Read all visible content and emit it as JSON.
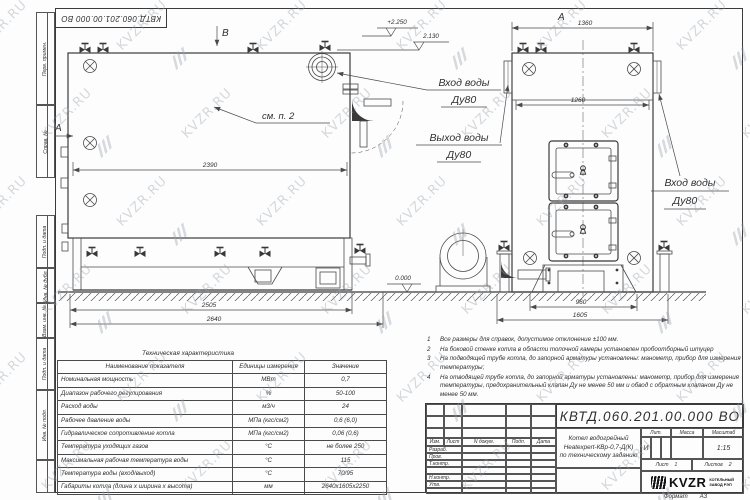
{
  "watermark": {
    "text": "KVZR.RU"
  },
  "frame": {
    "left_top": [
      "Перв. примен.",
      "Справ. №"
    ],
    "left_bottom": [
      "Подп. и дата",
      "Инв. № дубл.",
      "Взам. инв. №",
      "Подп. и дата",
      "Инв. № подл."
    ]
  },
  "drawing": {
    "section_a": "А",
    "section_b": "В",
    "view_label": "А",
    "callout": "см. п. 2",
    "inlet_label": "Вход воды",
    "outlet_label": "Выход воды",
    "dn_label": "Ду80",
    "level_top": "+2.250",
    "level_mid": "2.130",
    "level_zero": "0.000",
    "dim_2390": "2390",
    "dim_2505": "2505",
    "dim_2640": "2640",
    "dim_1360": "1360",
    "dim_1260": "1260",
    "dim_960": "960",
    "dim_1605": "1605"
  },
  "tech_table": {
    "title": "Техническая характеристика",
    "headers": [
      "Наименование показателя",
      "Единицы измерения",
      "Значение"
    ],
    "rows": [
      [
        "Номинальная мощность",
        "МВт",
        "0,7"
      ],
      [
        "Диапазон рабочего регулирования",
        "%",
        "50-100"
      ],
      [
        "Расход воды",
        "м3/ч",
        "24"
      ],
      [
        "Рабочее давление воды",
        "МПа (кгс/см2)",
        "0,6 (6,0)"
      ],
      [
        "Гидравлическое сопротивление котла",
        "МПа (кгс/см2)",
        "0,06 (0,6)"
      ],
      [
        "Температура уходящих газов",
        "°С",
        "не более 250"
      ],
      [
        "Максимальная рабочая температура воды",
        "°С",
        "115"
      ],
      [
        "Температура воды (вход/выход)",
        "°С",
        "70/95"
      ],
      [
        "Габариты котла (длина х ширина х высота)",
        "мм",
        "2640х1605х2250"
      ]
    ]
  },
  "notes": {
    "items": [
      {
        "num": "1",
        "text": "Все размеры для справок, допустимое отклонение ±100 мм."
      },
      {
        "num": "2",
        "text": "На боковой стенке котла в области топочной камеры установлен пробоотборный штуцер"
      },
      {
        "num": "3",
        "text": "На подводящей трубе котла, до запорной арматуры установлены: манометр, прибор для измерения температуры;"
      },
      {
        "num": "4",
        "text": "На отводящей трубе котла, до запорной арматуры установлены: манометр, прибор для измерения температуры, предохранительный клапан Ду не менее 50 мм и обвод с обратным клапаном Ду не менее 50 мм."
      }
    ]
  },
  "title_block": {
    "designation": "КВТД.060.201.00.000  ВО",
    "doc_title_line1": "Котел водогрейный",
    "doc_title_line2": "Heatexpert-КВр-0,7-Д(К)",
    "doc_title_line3": "по техническому заданию",
    "col_izm": "Изм.",
    "col_list": "Лист",
    "col_docum": "N докум.",
    "col_podp": "Подп.",
    "col_data": "Дата",
    "role_razrab": "Разраб.",
    "role_prov": "Пров.",
    "role_tkontr": "Т.контр.",
    "role_nkontr": "Н.контр.",
    "role_utv": "Утв.",
    "lit_header": "Лит.",
    "mass_header": "Масса",
    "scale_header": "Масштаб",
    "lit_value": "И",
    "scale_value": "1:15",
    "sheet_label": "Лист",
    "sheet_value": "1",
    "sheets_label": "Листов",
    "sheets_value": "2",
    "logo_text": "KVZR",
    "logo_sub1": "КОТЕЛЬНЫЙ",
    "logo_sub2": "ЗАВОД РЭП",
    "format_label": "Формат",
    "format_value": "А3"
  }
}
